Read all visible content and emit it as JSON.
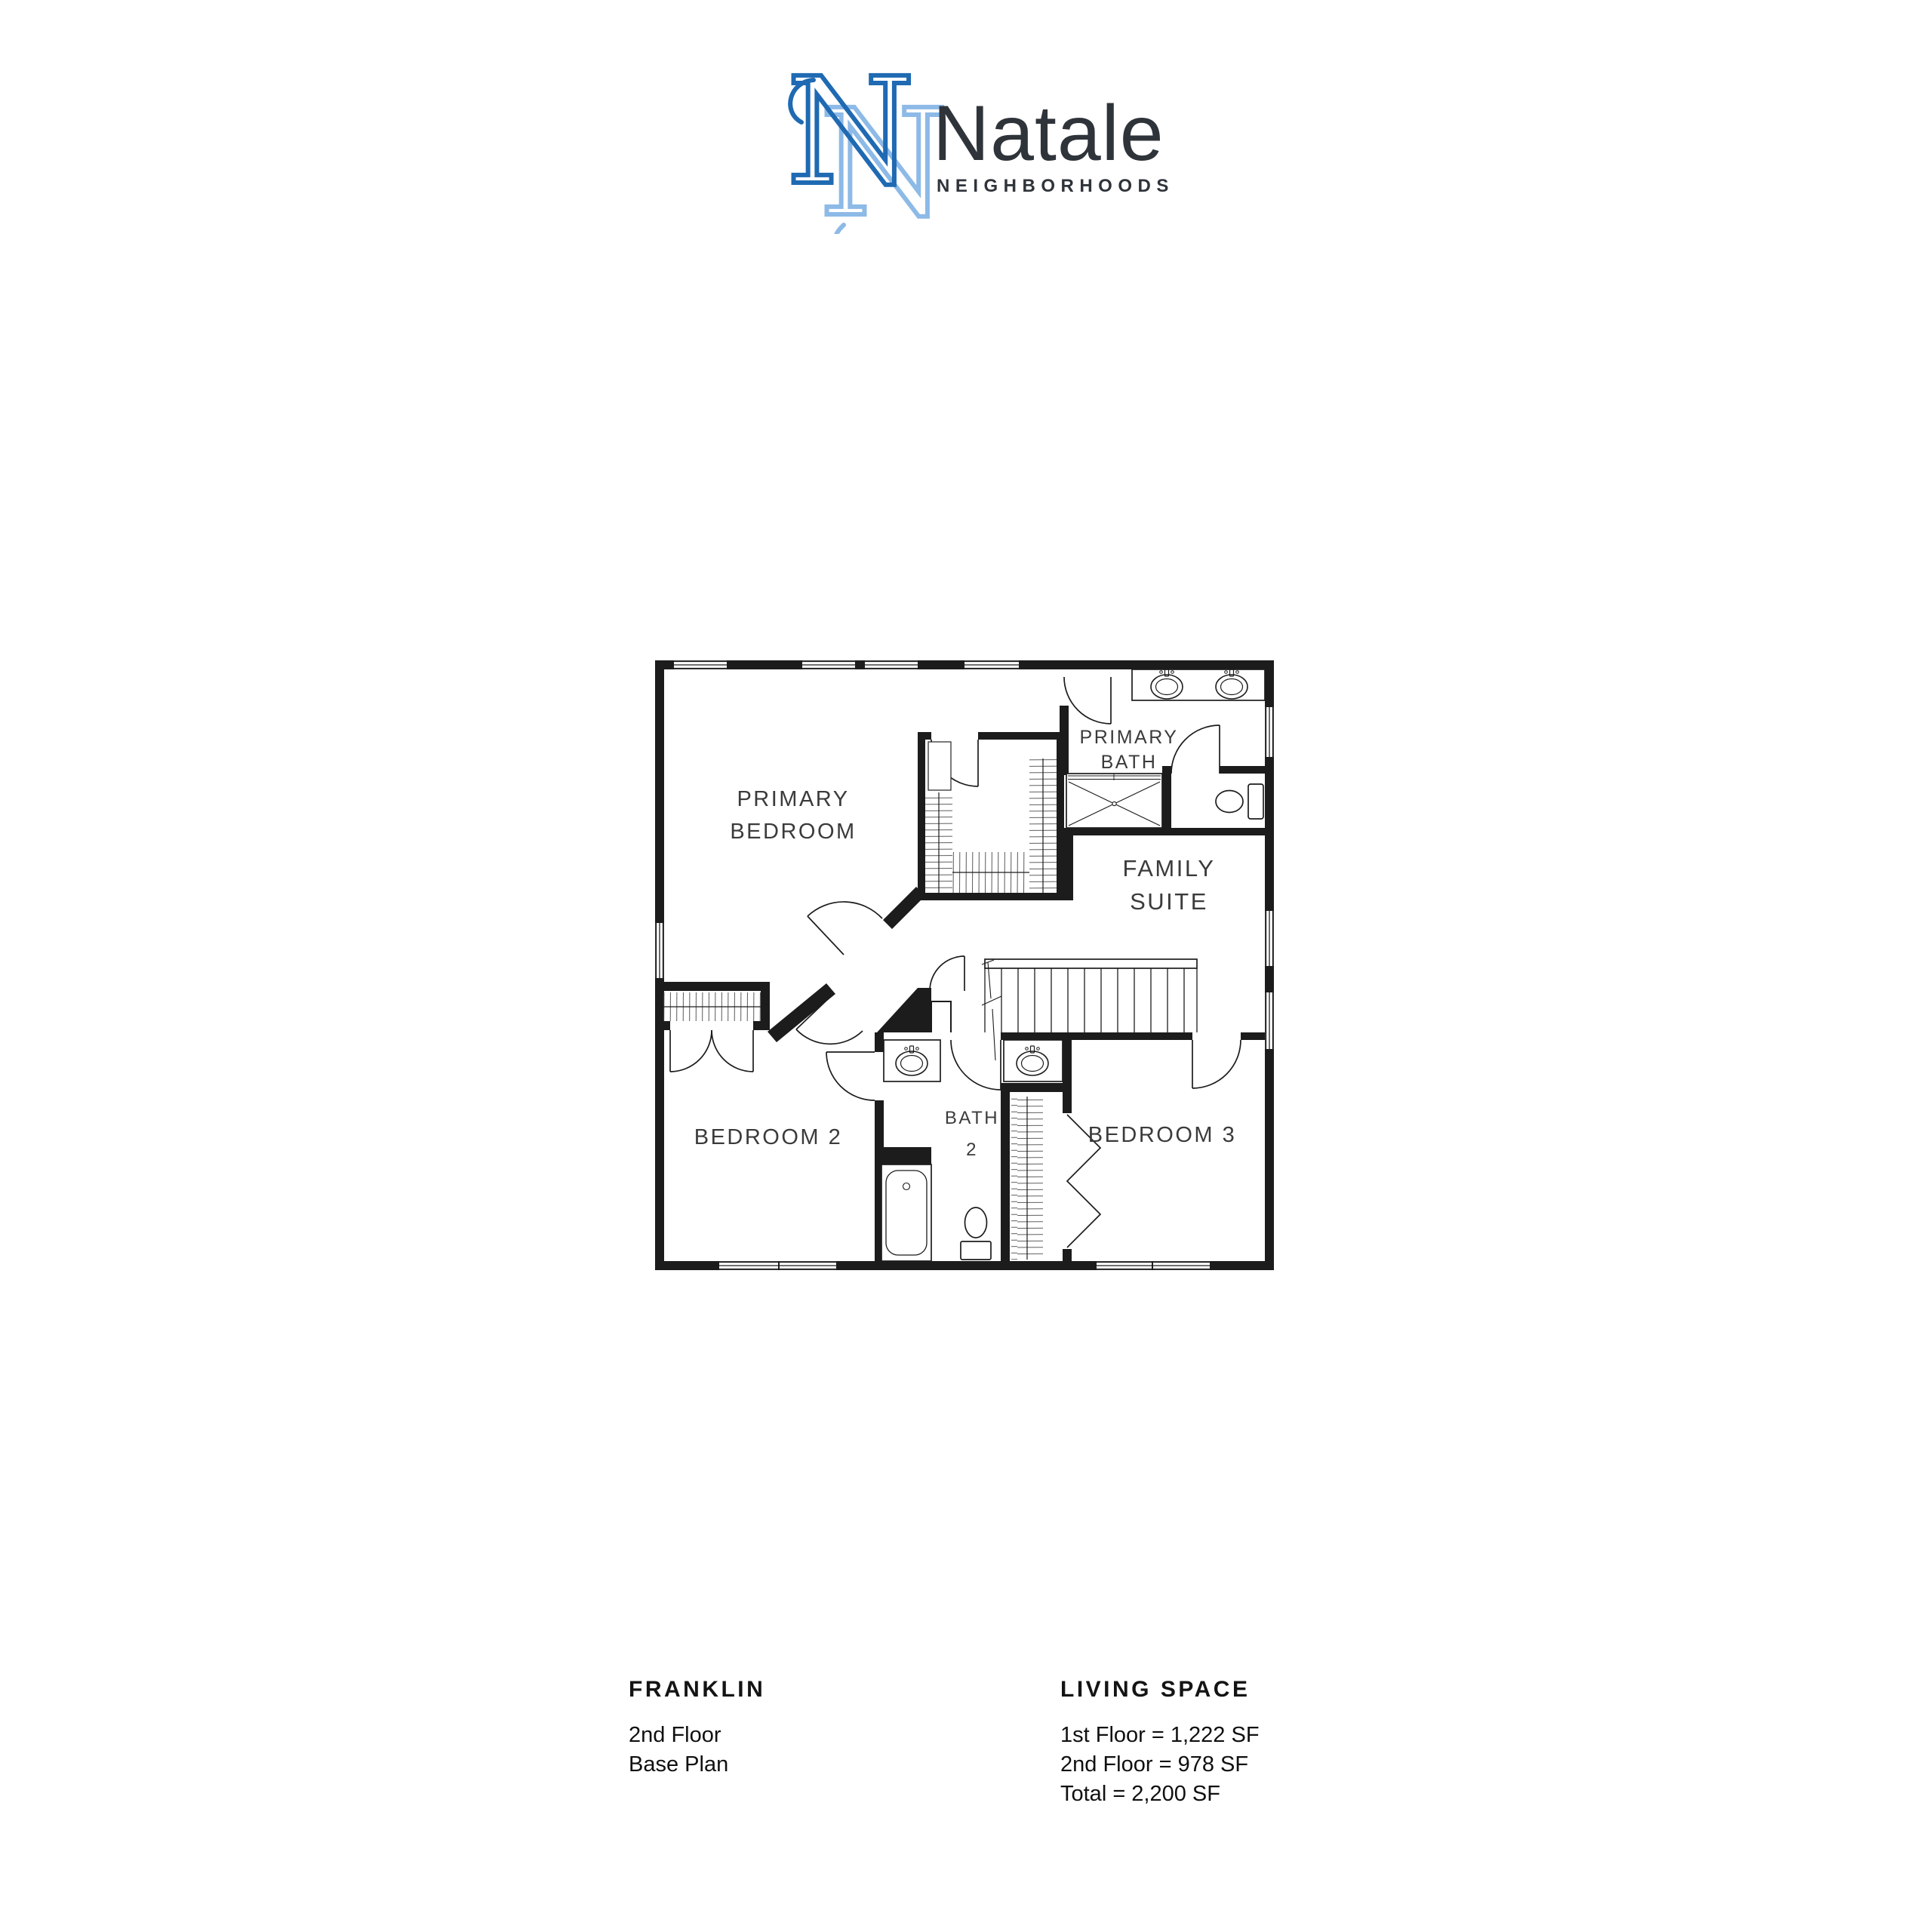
{
  "brand": {
    "monogram_letter": "N",
    "name": "Natale",
    "tagline": "NEIGHBORHOODS",
    "colors": {
      "monogram_dark": "#1f6ab2",
      "monogram_light": "#8dbae7",
      "wordmark": "#2f343a"
    }
  },
  "plan": {
    "colors": {
      "walls": "#1c1c1c",
      "labels": "#3b3b3b"
    },
    "labels": {
      "primary_bedroom": {
        "lines": [
          "PRIMARY",
          "BEDROOM"
        ]
      },
      "primary_bath": {
        "lines": [
          "PRIMARY",
          "BATH"
        ]
      },
      "family_suite": {
        "lines": [
          "FAMILY",
          "SUITE"
        ]
      },
      "bath_2": {
        "lines": [
          "BATH",
          "2"
        ]
      },
      "bedroom_2": {
        "label": "BEDROOM 2"
      },
      "bedroom_3": {
        "label": "BEDROOM 3"
      }
    }
  },
  "footer": {
    "plan_name": "FRANKLIN",
    "floor": "2nd Floor",
    "variant": "Base Plan",
    "living_space_title": "LIVING SPACE",
    "areas": [
      "1st Floor = 1,222 SF",
      "2nd Floor = 978 SF",
      "Total = 2,200 SF"
    ]
  }
}
